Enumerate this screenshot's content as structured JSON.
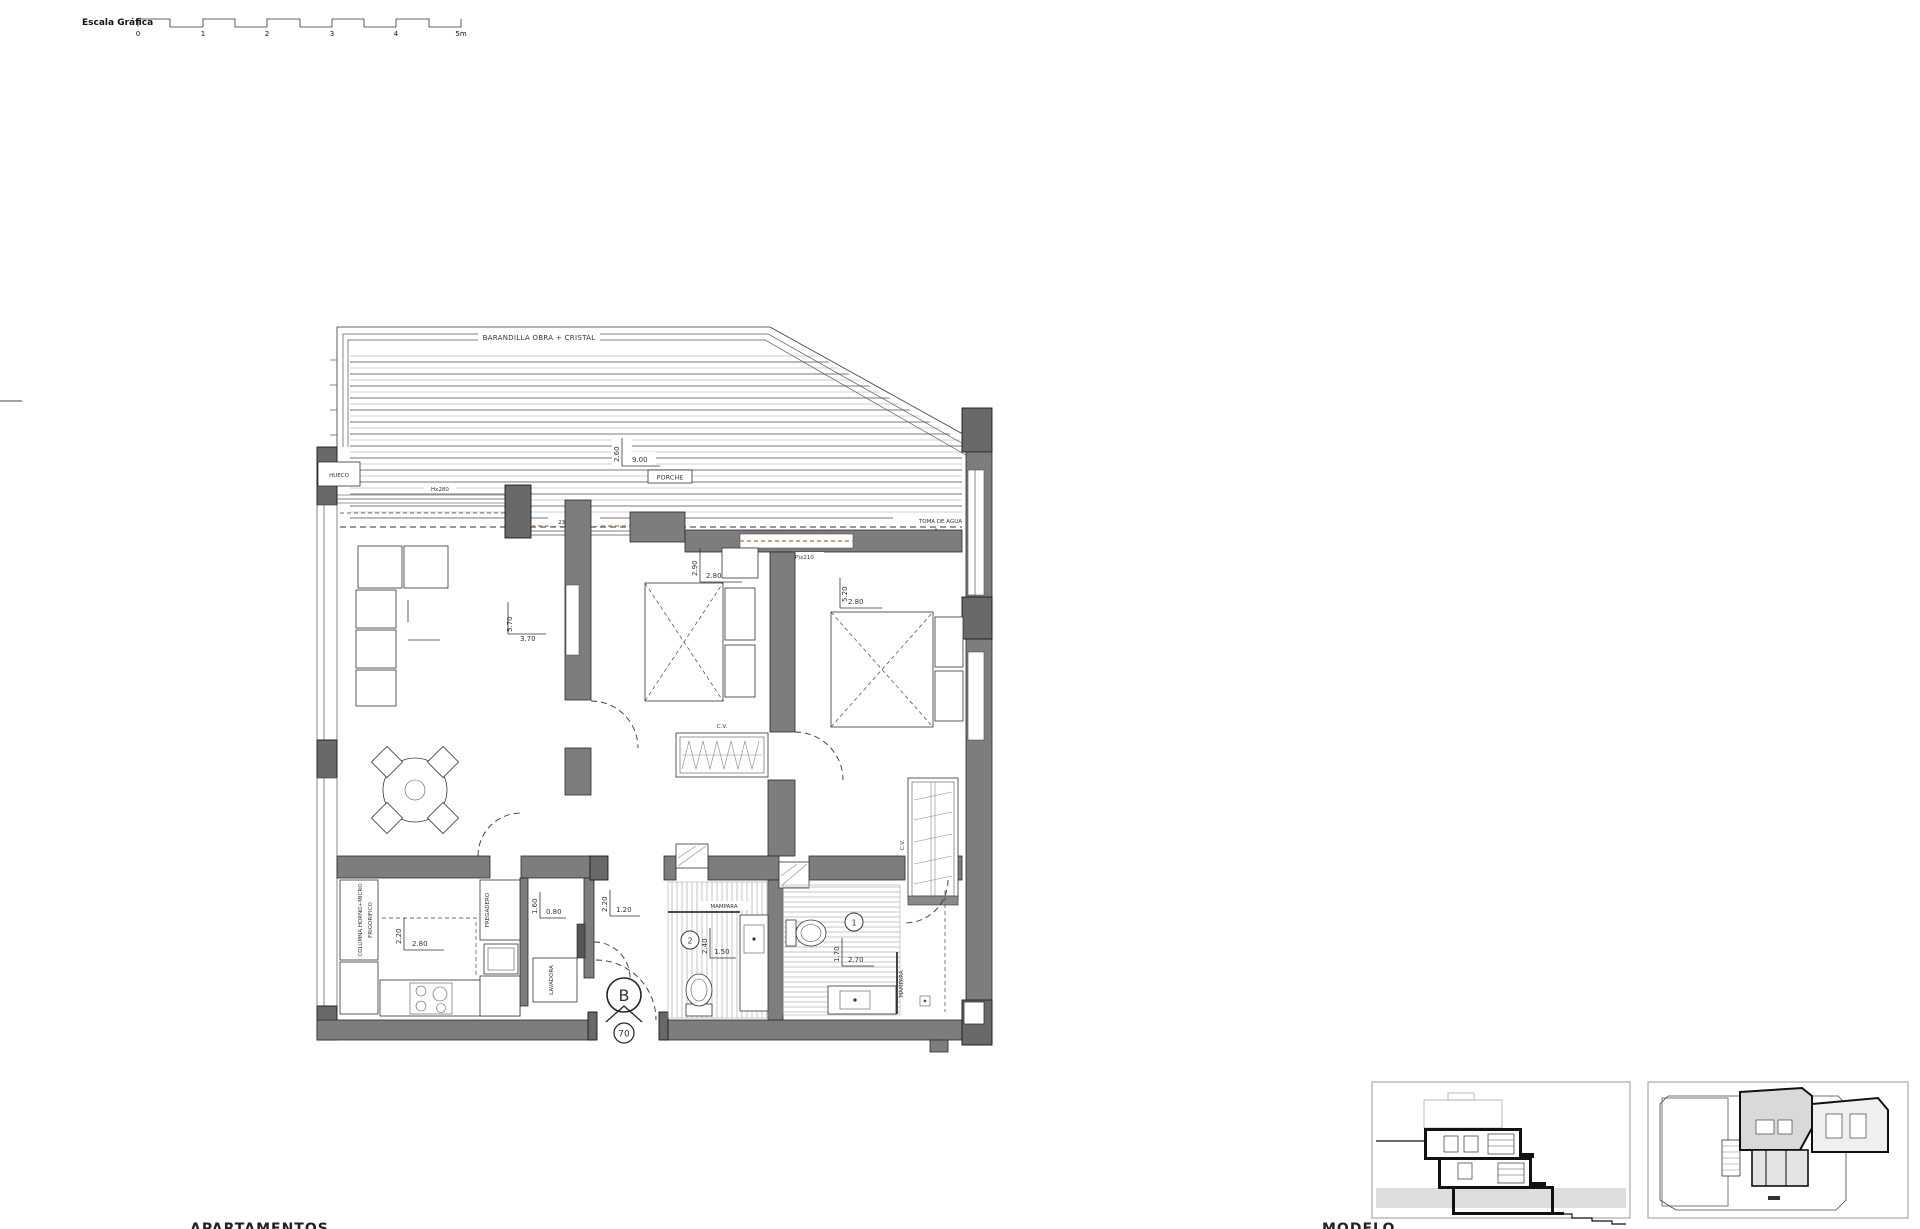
{
  "scale_bar": {
    "label": "Escala Gráfica",
    "ticks": [
      "0",
      "1",
      "2",
      "3",
      "4",
      "5m"
    ]
  },
  "terrace": {
    "railing_label": "BARANDILLA OBRA + CRISTAL",
    "porch_label": "PORCHE",
    "dim_depth": "2.60",
    "dim_width": "9.00",
    "opening_label": "HUECO",
    "window_height_label": "Hx280",
    "door_label_1": "230(P)x210",
    "door_label_2": "230(P)x210",
    "water_tap_label": "TOMA DE AGUA"
  },
  "living": {
    "dim_v": "5.70",
    "dim_h": "3.70"
  },
  "bedroom2": {
    "dim_v": "2.90",
    "dim_h": "2.80",
    "closet_label": "C.V."
  },
  "bedroom1": {
    "dim_v": "5.20",
    "dim_h": "2.80",
    "closet_label": "C.V."
  },
  "kitchen": {
    "dim_v": "2.20",
    "dim_h": "2.80",
    "column_label": "COLUMNA HORNO+MICRO",
    "fridge_label": "FRIGORIFICO",
    "sink_label": "FREGADERO"
  },
  "laundry": {
    "dim_v": "1.60",
    "dim_h": "0.80",
    "washer_label": "LAVADORA"
  },
  "hall": {
    "dim_v": "2.20",
    "dim_h": "1.20"
  },
  "bath2": {
    "number": "2",
    "dim_v": "2.40",
    "dim_h": "1.50",
    "screen_label": "MAMPARA"
  },
  "bath1": {
    "number": "1",
    "dim_v": "1.70",
    "dim_h": "2.70",
    "screen_label": "MAMPARA"
  },
  "unit": {
    "type_letter": "B",
    "unit_number": "70"
  },
  "footer": {
    "left_label": "APARTAMENTOS",
    "right_label": "MODELO"
  },
  "colors": {
    "wall": "#7d7d7d",
    "pillar": "#696969",
    "door_track": "#bf8a5e",
    "ground": "#dddddd"
  }
}
